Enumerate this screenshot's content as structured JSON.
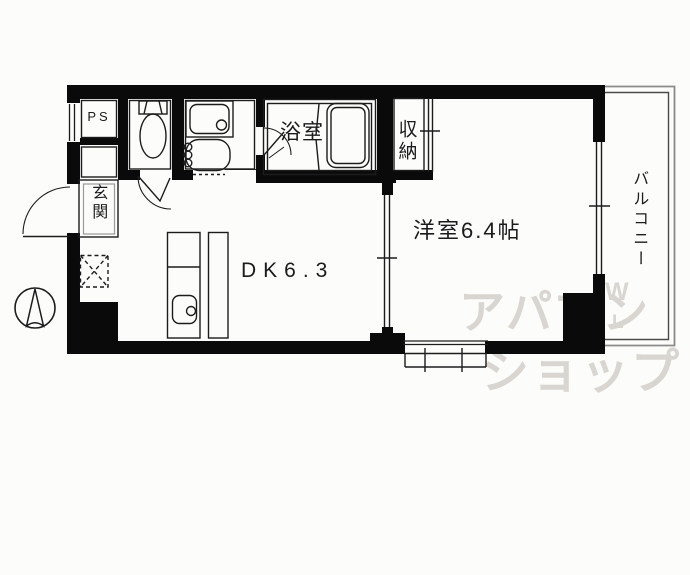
{
  "plan": {
    "type": "apartment-floor-plan",
    "rooms": {
      "ps": {
        "label": "PS"
      },
      "entrance": {
        "label": "玄関"
      },
      "bathroom": {
        "label": "浴室"
      },
      "storage": {
        "label": "収納"
      },
      "western_room": {
        "label": "洋室6.4帖"
      },
      "dining_kitchen": {
        "label": "DK6.3"
      },
      "balcony": {
        "label": "バルコニー"
      }
    },
    "watermark": {
      "line1": "アパマン",
      "line2": "ショップ",
      "mark_top": "W",
      "mark_bottom": "L"
    },
    "icons": {
      "compass": "north-arrow-icon",
      "fixtures": [
        "toilet",
        "washbasin",
        "washing-machine",
        "bathtub",
        "kitchen-sink",
        "refrigerator-space"
      ]
    },
    "colors": {
      "wall": "#0a0a0a",
      "line": "#1c1c1c",
      "balcony_line_outer": "#8a8a8a",
      "balcony_line_inner": "#4a4a4a",
      "watermark": "#d9d6d2",
      "background": "#fcfcfa"
    }
  }
}
